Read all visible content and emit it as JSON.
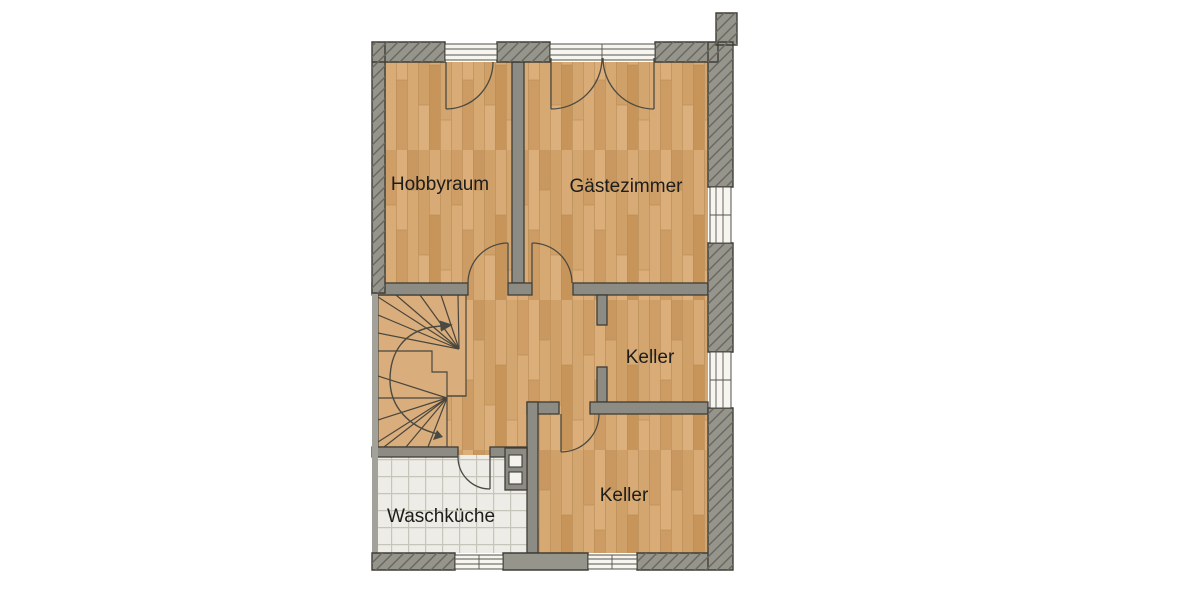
{
  "page": {
    "background": "#ffffff",
    "content_type": "floor-plan",
    "level": "Untergeschoss"
  },
  "floorplan": {
    "rooms": [
      {
        "id": "hobbyraum",
        "label": "Hobbyraum",
        "floor": "wood"
      },
      {
        "id": "gaestezimmer",
        "label": "Gästezimmer",
        "floor": "wood"
      },
      {
        "id": "keller1",
        "label": "Keller",
        "floor": "wood"
      },
      {
        "id": "keller2",
        "label": "Keller",
        "floor": "wood"
      },
      {
        "id": "waschkueche",
        "label": "Waschküche",
        "floor": "tile"
      },
      {
        "id": "flur",
        "label": "",
        "floor": "wood"
      }
    ],
    "features": {
      "stairs": "winder-staircase with up-arrow walking line",
      "windows_top": 2,
      "windows_right": 2,
      "windows_bottom": 2,
      "door_swings": 7,
      "chimney_flues": 2
    },
    "colors": {
      "wall": "#8d8c84",
      "wall_exterior": "#96958c",
      "wall_outline": "#3e3d36",
      "hatch_line": "#686760",
      "wood_base": "#d2a46e",
      "stair_wood": "#d9ae7c",
      "tile": "#edece6",
      "tile_grout": "#c7c4b9",
      "window_fill": "#f7f5ef",
      "door_arc": "#4b4a42",
      "label_color": "#1d1d1b"
    }
  }
}
